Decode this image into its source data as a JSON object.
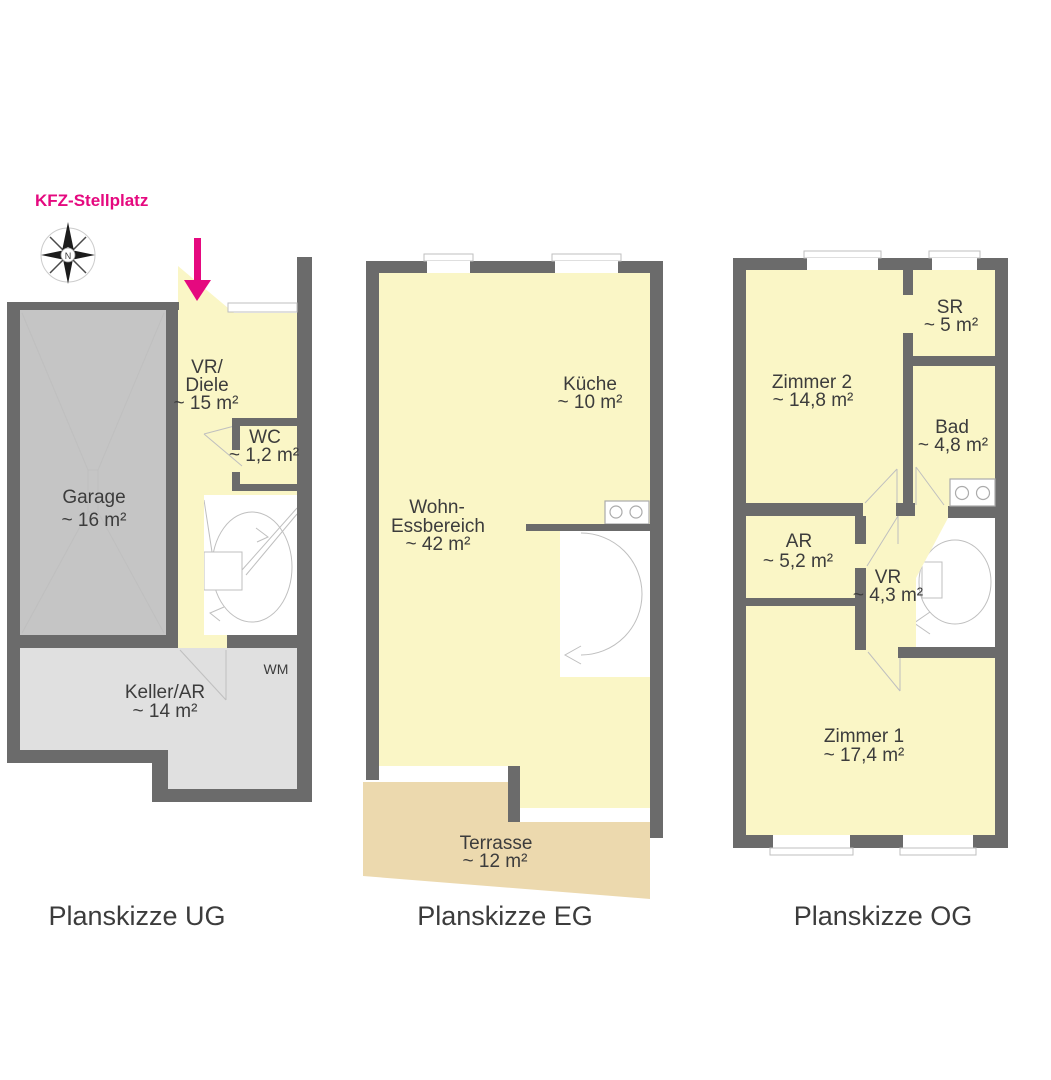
{
  "colors": {
    "wall": "#6b6b6b",
    "room": "#faf6c6",
    "garage": "#c5c5c5",
    "cellar": "#e0e0e0",
    "terrace": "#ecd9ae",
    "accent": "#e5097f",
    "text": "#3c3c3c",
    "thinline": "#bfbfbf"
  },
  "site": {
    "parking_label": "KFZ-Stellplatz",
    "compass_north": "N"
  },
  "plans": {
    "ug": {
      "title": "Planskizze UG",
      "rooms": {
        "garage": {
          "name": "Garage",
          "area": "~ 16 m²"
        },
        "vr_diele": {
          "name_line1": "VR/",
          "name_line2": "Diele",
          "area": "~ 15 m²"
        },
        "wc": {
          "name": "WC",
          "area": "~ 1,2 m²"
        },
        "keller_ar": {
          "name": "Keller/AR",
          "area": "~ 14 m²"
        }
      },
      "appliance_wm": "WM"
    },
    "eg": {
      "title": "Planskizze EG",
      "rooms": {
        "wohn_essbereich": {
          "name_line1": "Wohn-",
          "name_line2": "Essbereich",
          "area": "~ 42 m²"
        },
        "kueche": {
          "name": "Küche",
          "area": "~ 10 m²"
        },
        "terrasse": {
          "name": "Terrasse",
          "area": "~ 12 m²"
        }
      }
    },
    "og": {
      "title": "Planskizze OG",
      "rooms": {
        "zimmer2": {
          "name": "Zimmer 2",
          "area": "~ 14,8 m²"
        },
        "sr": {
          "name": "SR",
          "area": "~ 5 m²"
        },
        "bad": {
          "name": "Bad",
          "area": "~ 4,8 m²"
        },
        "ar": {
          "name": "AR",
          "area": "~ 5,2 m²"
        },
        "vr": {
          "name": "VR",
          "area": "~ 4,3 m²"
        },
        "zimmer1": {
          "name": "Zimmer 1",
          "area": "~ 17,4 m²"
        }
      }
    }
  }
}
